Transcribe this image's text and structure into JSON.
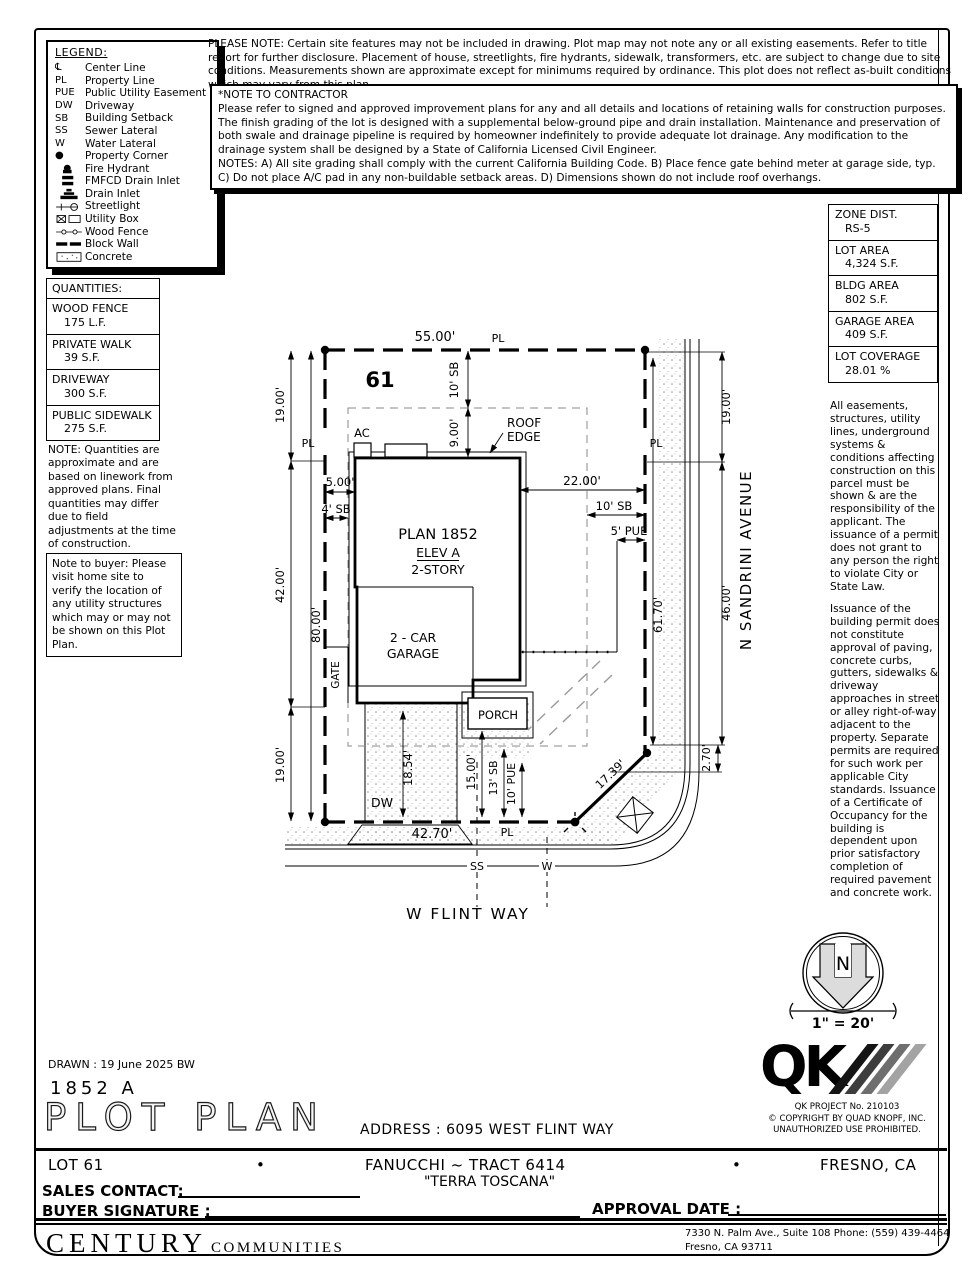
{
  "legend": {
    "title": "LEGEND:",
    "items": [
      {
        "sym": "℄",
        "label": "Center Line"
      },
      {
        "sym": "PL",
        "label": "Property Line"
      },
      {
        "sym": "PUE",
        "label": "Public Utility Easement"
      },
      {
        "sym": "DW",
        "label": "Driveway"
      },
      {
        "sym": "SB",
        "label": "Building Setback"
      },
      {
        "sym": "SS",
        "label": "Sewer Lateral"
      },
      {
        "sym": "W",
        "label": "Water Lateral"
      },
      {
        "sym": "●",
        "label": "Property Corner"
      },
      {
        "sym": "",
        "label": "Fire Hydrant"
      },
      {
        "sym": "",
        "label": "FMFCD Drain Inlet"
      },
      {
        "sym": "",
        "label": "Drain Inlet"
      },
      {
        "sym": "",
        "label": "Streetlight"
      },
      {
        "sym": "",
        "label": "Utility Box"
      },
      {
        "sym": "",
        "label": "Wood Fence"
      },
      {
        "sym": "",
        "label": "Block Wall"
      },
      {
        "sym": "",
        "label": "Concrete"
      }
    ]
  },
  "please_note": "PLEASE NOTE:  Certain site features may not be included in drawing.  Plot map may not note any or all existing easements. Refer to title report for further disclosure.  Placement of house, streetlights, fire hydrants, sidewalk, transformers, etc. are subject to change due to site conditions.  Measurements shown are approximate except for minimums required by ordinance.  This plot does not reflect as-built conditions which may vary from this plan.",
  "contractor_note": {
    "title": "*NOTE TO CONTRACTOR",
    "line1": "Please refer to signed and approved improvement plans for any and all details and locations of retaining walls for construction purposes.",
    "line2": "The finish grading of the lot is designed with a supplemental below-ground pipe and drain installation.  Maintenance and preservation of both swale and drainage pipeline is required by homeowner indefinitely to provide adequate lot drainage.  Any modification to the drainage system shall be designed by a State of California Licensed Civil Engineer.",
    "line3": "NOTES:  A) All site grading shall comply with the current California Building Code.  B) Place fence gate behind meter at garage side, typ.  C) Do not place A/C pad in any non-buildable setback areas.  D) Dimensions shown do not include roof overhangs."
  },
  "zone_table": [
    {
      "label": "ZONE DIST.",
      "value": "RS-5"
    },
    {
      "label": "LOT AREA",
      "value": "4,324 S.F."
    },
    {
      "label": "BLDG AREA",
      "value": "802 S.F."
    },
    {
      "label": "GARAGE AREA",
      "value": "409 S.F."
    },
    {
      "label": "LOT COVERAGE",
      "value": "28.01 %"
    }
  ],
  "quantities": {
    "title": "QUANTITIES:",
    "items": [
      {
        "label": "WOOD FENCE",
        "value": "175 L.F."
      },
      {
        "label": "PRIVATE WALK",
        "value": "39 S.F."
      },
      {
        "label": "DRIVEWAY",
        "value": "300 S.F."
      },
      {
        "label": "PUBLIC SIDEWALK",
        "value": "275 S.F."
      }
    ]
  },
  "quantities_note": "NOTE: Quantities are approximate and are based on linework from approved plans.  Final quantities may differ due to field adjustments at the time of construction.",
  "buyer_note": "Note to buyer: Please visit home site to verify the location of any utility structures which may or may not be shown on this Plot Plan.",
  "easements_note": {
    "p1": "All easements, structures, utility lines, underground systems & conditions affecting construction on this parcel must be shown & are the responsibility of the applicant. The issuance of a permit does not grant to any person the right to violate City or State Law.",
    "p2": "Issuance of the building permit does not constitute approval of paving, concrete curbs, gutters, sidewalks & driveway approaches in street or alley right-of-way adjacent to the property. Separate permits are required for such work per applicable City standards. Issuance of a Certificate of Occupancy for the building is dependent upon prior satisfactory completion of required pavement and concrete work."
  },
  "plot": {
    "lot_number": "61",
    "pl": "PL",
    "d55": "55.00'",
    "d19a": "19.00'",
    "d42": "42.00'",
    "d19b": "19.00'",
    "d80": "80.00'",
    "d10sb_top": "10' SB",
    "d9": "9.00'",
    "d5": "5.00'",
    "d4sb": "4' SB",
    "d22": "22.00'",
    "d10sb_right": "10' SB",
    "d5pue": "5' PUE",
    "d61_70": "61.70'",
    "d19c": "19.00'",
    "d46": "46.00'",
    "d2_70": "2.70'",
    "d17_39": "17.39'",
    "d18_54": "18.54'",
    "d15": "15.00'",
    "d13sb": "13' SB",
    "d10pue": "10' PUE",
    "d42_70": "42.70'",
    "ac": "AC",
    "roof1": "ROOF",
    "roof2": "EDGE",
    "plan": "PLAN 1852",
    "elev": "ELEV A",
    "story": "2-STORY",
    "garage1": "2 - CAR",
    "garage2": "GARAGE",
    "gate": "GATE",
    "porch": "PORCH",
    "dw": "DW",
    "ss": "SS",
    "w": "W",
    "street_bottom": "W FLINT WAY",
    "street_right": "N SANDRINI AVENUE"
  },
  "north": {
    "n": "N",
    "scale": "1\" = 20'"
  },
  "qk": {
    "letters": "QK",
    "project": "QK PROJECT No. 210103",
    "copyright": "©  COPYRIGHT BY QUAD KNOPF, INC.",
    "unauthorized": "UNAUTHORIZED USE PROHIBITED."
  },
  "titleblock": {
    "drawn": "DRAWN :  19 June 2025  BW",
    "plan_no": "1852  A",
    "title": "PLOT PLAN",
    "address": "ADDRESS :  6095 WEST FLINT WAY",
    "lot": "LOT 61",
    "bullet": "•",
    "tract": "FANUCCHI ~ TRACT 6414",
    "city": "FRESNO, CA",
    "community": "\"TERRA TOSCANA\"",
    "sales_label": "SALES CONTACT:",
    "buyer_label": "BUYER SIGNATURE :",
    "approval_label": "APPROVAL DATE :"
  },
  "century": {
    "name": "CENTURY",
    "sub": "COMMUNITIES",
    "addr1": "7330 N. Palm Ave., Suite 108    Phone:  (559) 439-4464",
    "addr2": "Fresno, CA  93711"
  }
}
